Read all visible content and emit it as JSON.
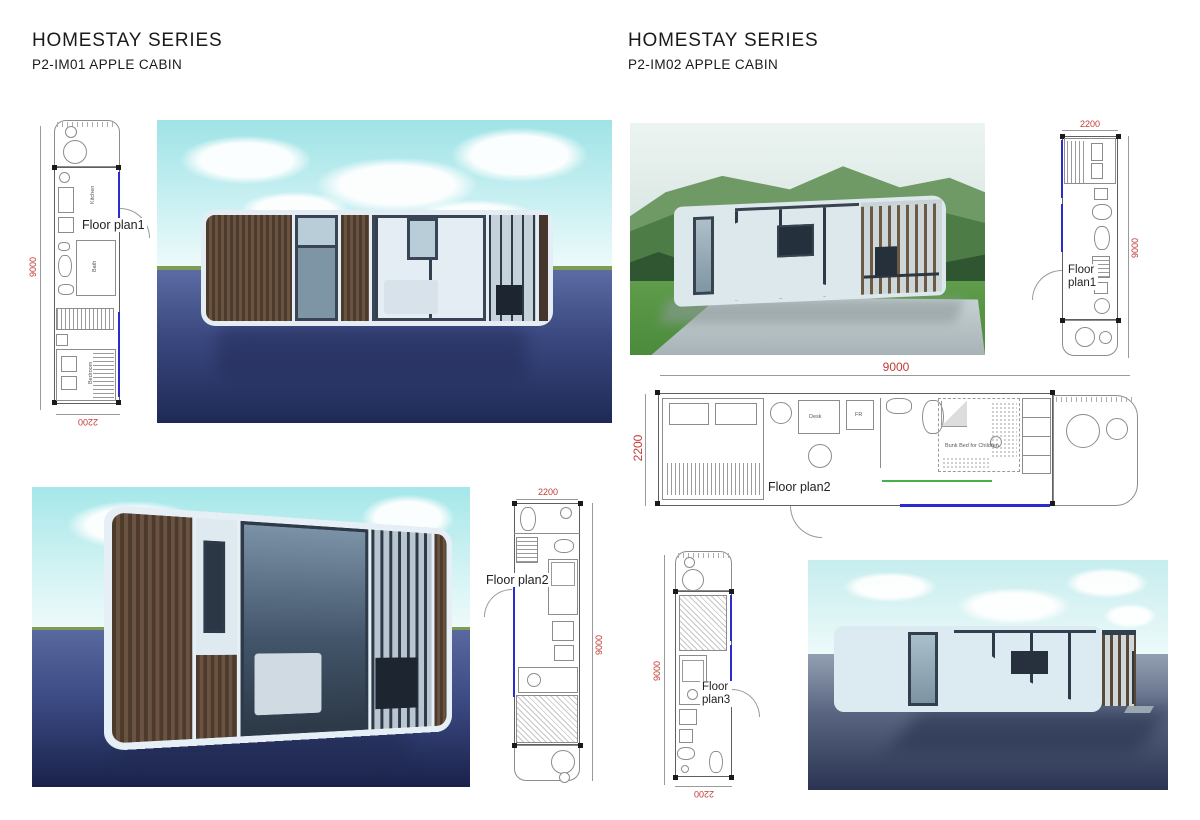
{
  "page": {
    "background": "#ffffff"
  },
  "header_left": {
    "title": "HOMESTAY SERIES",
    "subtitle": "P2-IM01 APPLE CABIN"
  },
  "header_right": {
    "title": "HOMESTAY SERIES",
    "subtitle": "P2-IM02 APPLE CABIN"
  },
  "plans": {
    "a": {
      "label": "Floor plan1",
      "dim_height": "9000",
      "dim_width": "2200",
      "rooms": {
        "kitchen": "Kitchen",
        "bath": "Bath",
        "bedroom": "Bedroom"
      }
    },
    "b": {
      "label_line1": "Floor",
      "label_line2": "plan1",
      "dim_width": "2200",
      "dim_height": "9000"
    },
    "c": {
      "label": "Floor plan2",
      "dim_width": "9000",
      "dim_height": "2200",
      "annotations": {
        "desk": "Desk",
        "fridge": "FR",
        "bunk": "Bunk Bed for Children"
      }
    },
    "d": {
      "label": "Floor plan2",
      "dim_width": "2200",
      "dim_height": "9000"
    },
    "e": {
      "label_line1": "Floor",
      "label_line2": "plan3",
      "dim_width": "2200",
      "dim_height": "9000"
    }
  },
  "colors": {
    "dimension_text": "#c13b34",
    "window_line": "#2b2bd0",
    "shower_glass_line": "#46b14c",
    "plan_line": "#6a6a6a",
    "sky_teal": "#a9e8ea",
    "water_navy": "#1e2a55",
    "cabin_shell": "#e4edf4",
    "wood": "#5a4636"
  }
}
